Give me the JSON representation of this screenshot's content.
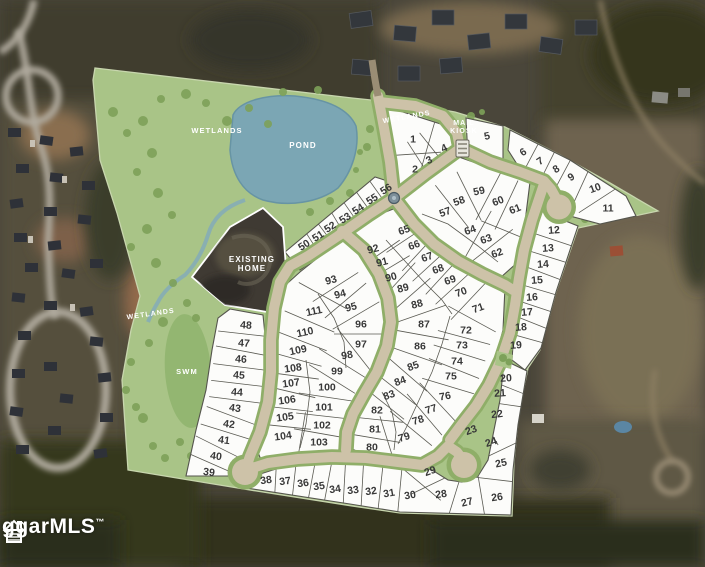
{
  "map": {
    "labels": [
      {
        "id": "wetlands-1",
        "lines": [
          "WETLANDS"
        ],
        "x": 217,
        "y": 133,
        "r": 0,
        "size": 7.5
      },
      {
        "id": "wetlands-2",
        "lines": [
          "WETLANDS"
        ],
        "x": 407,
        "y": 119,
        "r": -10,
        "size": 7
      },
      {
        "id": "wetlands-3",
        "lines": [
          "WETLANDS"
        ],
        "x": 151,
        "y": 316,
        "r": -8,
        "size": 7
      },
      {
        "id": "pond",
        "lines": [
          "POND"
        ],
        "x": 303,
        "y": 148,
        "r": 0,
        "size": 8
      },
      {
        "id": "swm",
        "lines": [
          "SWM"
        ],
        "x": 187,
        "y": 374,
        "r": 0,
        "size": 7.5
      },
      {
        "id": "existing-home",
        "lines": [
          "EXISTING",
          "HOME"
        ],
        "x": 252,
        "y": 262,
        "r": 0,
        "size": 8
      },
      {
        "id": "mail-kiosk",
        "lines": [
          "MAIL",
          "KIOSK"
        ],
        "x": 464,
        "y": 125,
        "r": 0,
        "size": 7
      }
    ],
    "lots": [
      [
        1,
        413,
        139,
        0
      ],
      [
        2,
        415,
        169,
        0
      ],
      [
        3,
        429,
        160,
        -25
      ],
      [
        4,
        444,
        148,
        -25
      ],
      [
        5,
        487,
        136,
        -12
      ],
      [
        6,
        523,
        152,
        -33
      ],
      [
        7,
        540,
        161,
        -33
      ],
      [
        8,
        556,
        169,
        -33
      ],
      [
        9,
        571,
        177,
        -33
      ],
      [
        10,
        595,
        188,
        -20
      ],
      [
        11,
        608,
        208,
        0
      ],
      [
        12,
        554,
        230,
        -4
      ],
      [
        13,
        548,
        248,
        -4
      ],
      [
        14,
        543,
        264,
        -4
      ],
      [
        15,
        537,
        280,
        -4
      ],
      [
        16,
        532,
        297,
        -4
      ],
      [
        17,
        527,
        312,
        -4
      ],
      [
        18,
        521,
        327,
        -4
      ],
      [
        19,
        516,
        345,
        -4
      ],
      [
        20,
        506,
        378,
        -4
      ],
      [
        21,
        500,
        393,
        -4
      ],
      [
        22,
        497,
        414,
        -6
      ],
      [
        23,
        471,
        430,
        -20
      ],
      [
        24,
        491,
        442,
        -18
      ],
      [
        25,
        501,
        463,
        -12
      ],
      [
        26,
        497,
        497,
        -8
      ],
      [
        27,
        467,
        502,
        -14
      ],
      [
        28,
        441,
        494,
        -8
      ],
      [
        29,
        430,
        471,
        -20
      ],
      [
        30,
        410,
        495,
        -10
      ],
      [
        31,
        389,
        493,
        -10
      ],
      [
        32,
        371,
        491,
        -8
      ],
      [
        33,
        353,
        490,
        -8
      ],
      [
        34,
        335,
        489,
        -8
      ],
      [
        35,
        319,
        486,
        -8
      ],
      [
        36,
        303,
        483,
        -8
      ],
      [
        37,
        285,
        481,
        -8
      ],
      [
        38,
        266,
        480,
        -8
      ],
      [
        39,
        209,
        472,
        7
      ],
      [
        40,
        216,
        456,
        7
      ],
      [
        41,
        224,
        440,
        7
      ],
      [
        42,
        229,
        424,
        7
      ],
      [
        43,
        235,
        408,
        7
      ],
      [
        44,
        237,
        392,
        4
      ],
      [
        45,
        239,
        375,
        4
      ],
      [
        46,
        241,
        359,
        4
      ],
      [
        47,
        244,
        343,
        4
      ],
      [
        48,
        246,
        325,
        4
      ],
      [
        50,
        304,
        245,
        -33
      ],
      [
        51,
        318,
        236,
        -33
      ],
      [
        52,
        330,
        227,
        -33
      ],
      [
        53,
        345,
        218,
        -33
      ],
      [
        54,
        358,
        209,
        -33
      ],
      [
        55,
        372,
        199,
        -33
      ],
      [
        56,
        386,
        189,
        -33
      ],
      [
        57,
        445,
        212,
        -20
      ],
      [
        58,
        459,
        201,
        -20
      ],
      [
        59,
        479,
        191,
        -12
      ],
      [
        60,
        498,
        201,
        -22
      ],
      [
        61,
        515,
        209,
        -22
      ],
      [
        62,
        497,
        253,
        -20
      ],
      [
        63,
        486,
        239,
        -20
      ],
      [
        64,
        470,
        230,
        -20
      ],
      [
        65,
        404,
        230,
        -20
      ],
      [
        66,
        414,
        245,
        -20
      ],
      [
        67,
        427,
        257,
        -20
      ],
      [
        68,
        438,
        269,
        -20
      ],
      [
        69,
        450,
        280,
        -20
      ],
      [
        70,
        461,
        292,
        -20
      ],
      [
        71,
        478,
        308,
        -20
      ],
      [
        72,
        466,
        330,
        0
      ],
      [
        73,
        462,
        345,
        0
      ],
      [
        74,
        457,
        361,
        0
      ],
      [
        75,
        451,
        376,
        0
      ],
      [
        76,
        445,
        396,
        -10
      ],
      [
        77,
        431,
        409,
        -18
      ],
      [
        78,
        418,
        420,
        -18
      ],
      [
        79,
        404,
        437,
        -18
      ],
      [
        80,
        372,
        447,
        0
      ],
      [
        81,
        375,
        429,
        0
      ],
      [
        82,
        377,
        410,
        0
      ],
      [
        83,
        389,
        395,
        -20
      ],
      [
        84,
        400,
        381,
        -20
      ],
      [
        85,
        413,
        366,
        -20
      ],
      [
        86,
        420,
        346,
        0
      ],
      [
        87,
        424,
        324,
        0
      ],
      [
        88,
        417,
        304,
        -15
      ],
      [
        89,
        403,
        288,
        -15
      ],
      [
        90,
        391,
        277,
        -15
      ],
      [
        91,
        382,
        262,
        -15
      ],
      [
        92,
        373,
        249,
        -15
      ],
      [
        93,
        331,
        280,
        -15
      ],
      [
        94,
        340,
        294,
        -15
      ],
      [
        95,
        351,
        307,
        -15
      ],
      [
        96,
        361,
        324,
        0
      ],
      [
        97,
        361,
        344,
        0
      ],
      [
        98,
        347,
        355,
        -10
      ],
      [
        99,
        337,
        371,
        0
      ],
      [
        100,
        327,
        387,
        0
      ],
      [
        101,
        324,
        407,
        0
      ],
      [
        102,
        322,
        425,
        0
      ],
      [
        103,
        319,
        442,
        0
      ],
      [
        104,
        283,
        436,
        -8
      ],
      [
        105,
        285,
        417,
        -8
      ],
      [
        106,
        287,
        400,
        -8
      ],
      [
        107,
        291,
        383,
        -8
      ],
      [
        108,
        293,
        368,
        -8
      ],
      [
        109,
        298,
        350,
        -12
      ],
      [
        110,
        305,
        332,
        -12
      ],
      [
        111,
        314,
        311,
        -12
      ]
    ],
    "watermark": {
      "text": "ggarMLS",
      "tm": "™"
    },
    "colors": {
      "site_green": "#a9c487",
      "tree_green": "#7da159",
      "swm_green": "#93b671",
      "pond_blue": "#7ba6b4",
      "stream_blue": "#84abb8",
      "road_tan": "#cdc2a8",
      "lot_fill": "#fcfcfa",
      "lot_line": "#55554d",
      "number": "#383838",
      "label": "#ffffff"
    }
  }
}
